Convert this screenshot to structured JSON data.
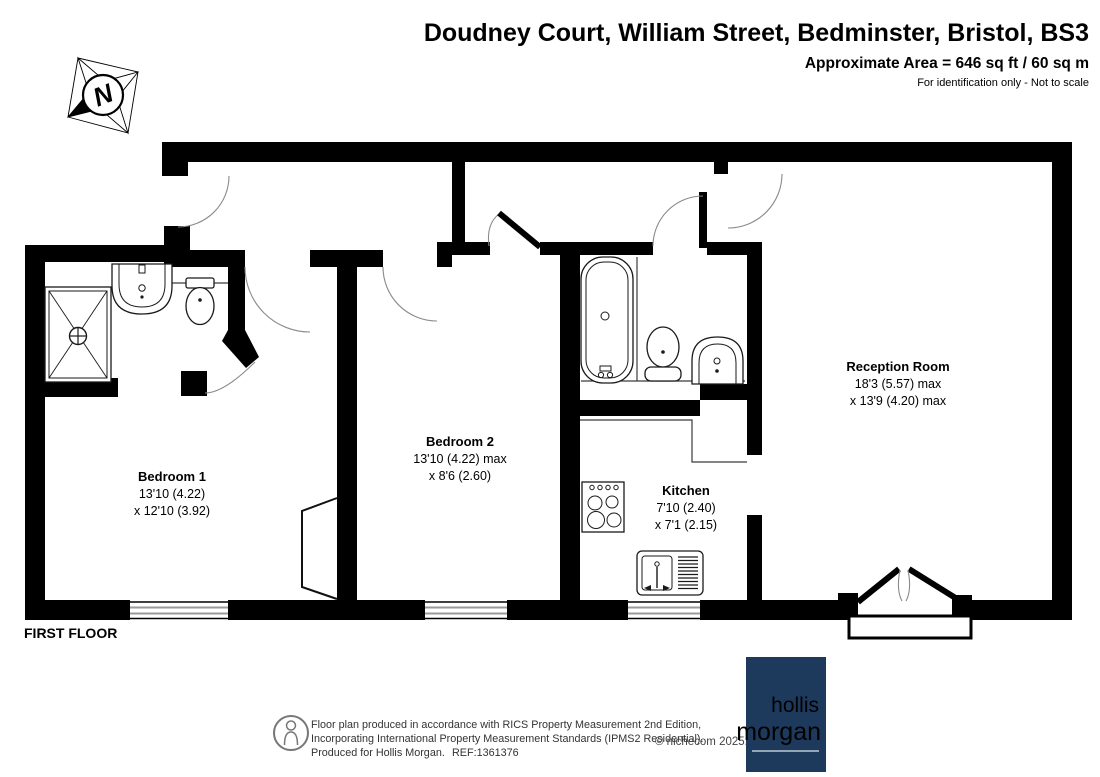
{
  "header": {
    "title": "Doudney Court, William Street, Bedminster, Bristol, BS3",
    "area": "Approximate Area = 646 sq ft / 60 sq m",
    "note": "For identification only - Not to scale"
  },
  "plan": {
    "floor_label": "FIRST FLOOR",
    "compass_letter": "N",
    "rooms": [
      {
        "name": "Bedroom 1",
        "dim1": "13'10 (4.22)",
        "dim2": "x 12'10 (3.92)"
      },
      {
        "name": "Bedroom 2",
        "dim1": "13'10 (4.22) max",
        "dim2": "x 8'6 (2.60)"
      },
      {
        "name": "Kitchen",
        "dim1": "7'10 (2.40)",
        "dim2": "x 7'1 (2.15)"
      },
      {
        "name": "Reception Room",
        "dim1": "18'3 (5.57) max",
        "dim2": "x 13'9 (4.20) max"
      }
    ]
  },
  "footer": {
    "line1": "Floor plan produced in accordance with RICS Property Measurement 2nd Edition,",
    "line2": "Incorporating International Property Measurement Standards (IPMS2 Residential).",
    "line3": "Produced for Hollis Morgan.",
    "ref": "REF:1361376",
    "copyright": "© nichecom 2025."
  },
  "logo": {
    "word1": "hollis",
    "word2": "morgan",
    "bg": "#1d3a5c",
    "word1_color": "#b9c9d4",
    "word2_color": "#8bc53e"
  },
  "colors": {
    "wall": "#000000",
    "arc": "#8a8a8a"
  }
}
